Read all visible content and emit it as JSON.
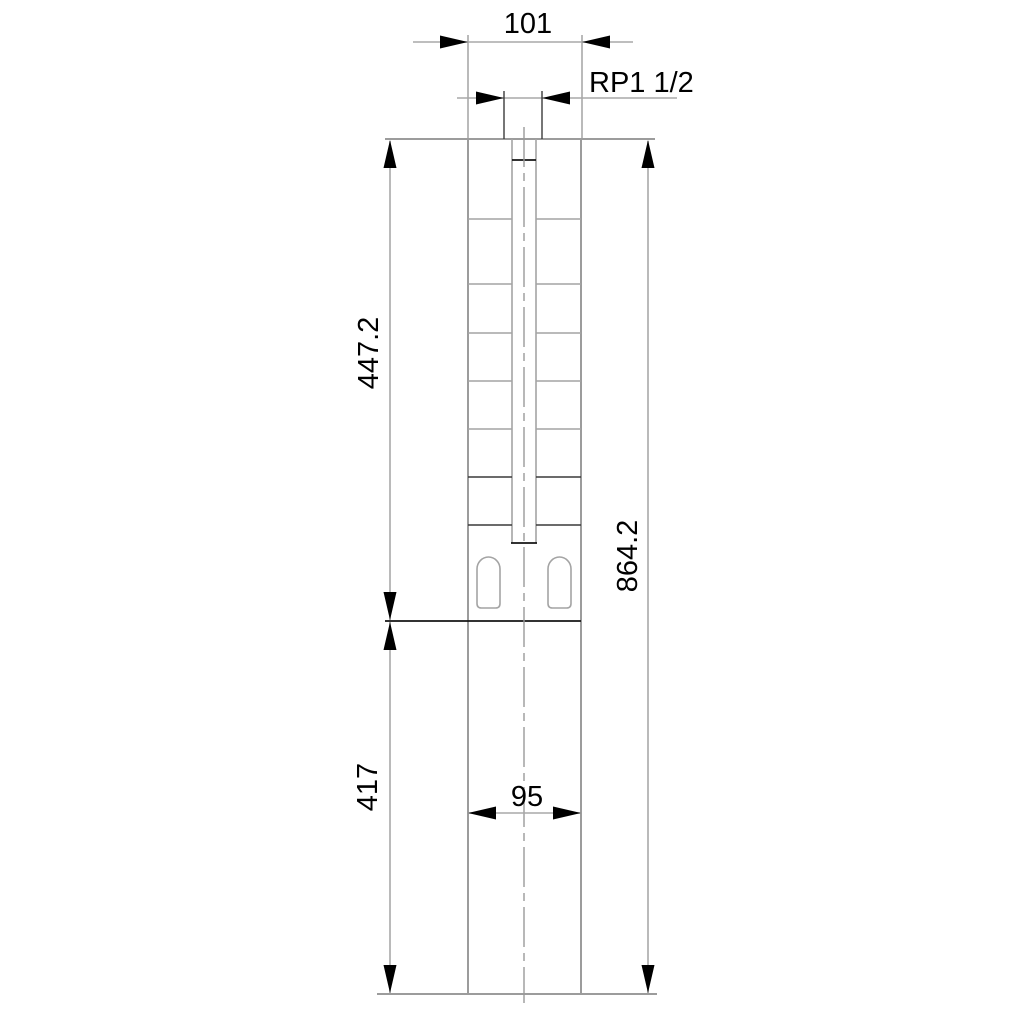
{
  "drawing": {
    "type": "technical-dimension-drawing",
    "subject": "submersible-borehole-pump-outline",
    "labels": {
      "dim_top_width": "101",
      "dim_thread": "RP1 1/2",
      "dim_pump_length": "447.2",
      "dim_total_length": "864.2",
      "dim_motor_length": "417",
      "dim_motor_width": "95"
    },
    "colors": {
      "background": "#ffffff",
      "object_line": "#9c9c9c",
      "dimension_line": "#a8a8a8",
      "accent_line": "#141414",
      "text": "#000000"
    }
  }
}
